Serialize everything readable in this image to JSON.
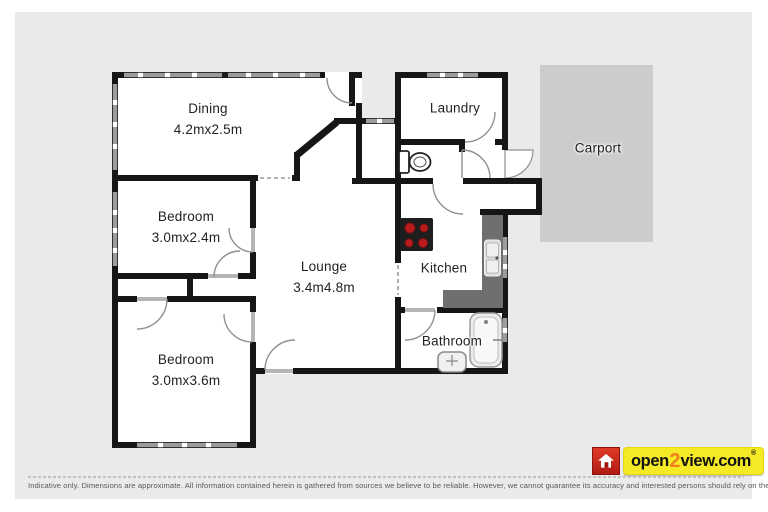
{
  "rooms": {
    "dining": {
      "name": "Dining",
      "dims": "4.2mx2.5m"
    },
    "laundry": {
      "name": "Laundry"
    },
    "carport": {
      "name": "Carport"
    },
    "bedroom1": {
      "name": "Bedroom",
      "dims": "3.0mx2.4m"
    },
    "lounge": {
      "name": "Lounge",
      "dims": "3.4m4.8m"
    },
    "kitchen": {
      "name": "Kitchen"
    },
    "bedroom2": {
      "name": "Bedroom",
      "dims": "3.0mx3.6m"
    },
    "bathroom": {
      "name": "Bathroom"
    }
  },
  "footer": {
    "disclaimer": "Indicative only. Dimensions are approximate. All information contained herein is gathered from sources we believe to be reliable. However, we cannot guarantee its accuracy and interested persons should rely on their own enquiries."
  },
  "logo": {
    "open": "open",
    "two": "2",
    "view": "view.com",
    "registered": "®"
  },
  "colors": {
    "plan_background": "#e9eaeb",
    "carport_fill": "#cbcccd",
    "wall": "#161616",
    "window": "#9c9c9c",
    "counter": "#6f6f6f",
    "stove_burner": "#b91c1c",
    "logo_red": "#d6251f",
    "logo_yellow": "#f6e926",
    "logo_orange": "#f08019"
  }
}
